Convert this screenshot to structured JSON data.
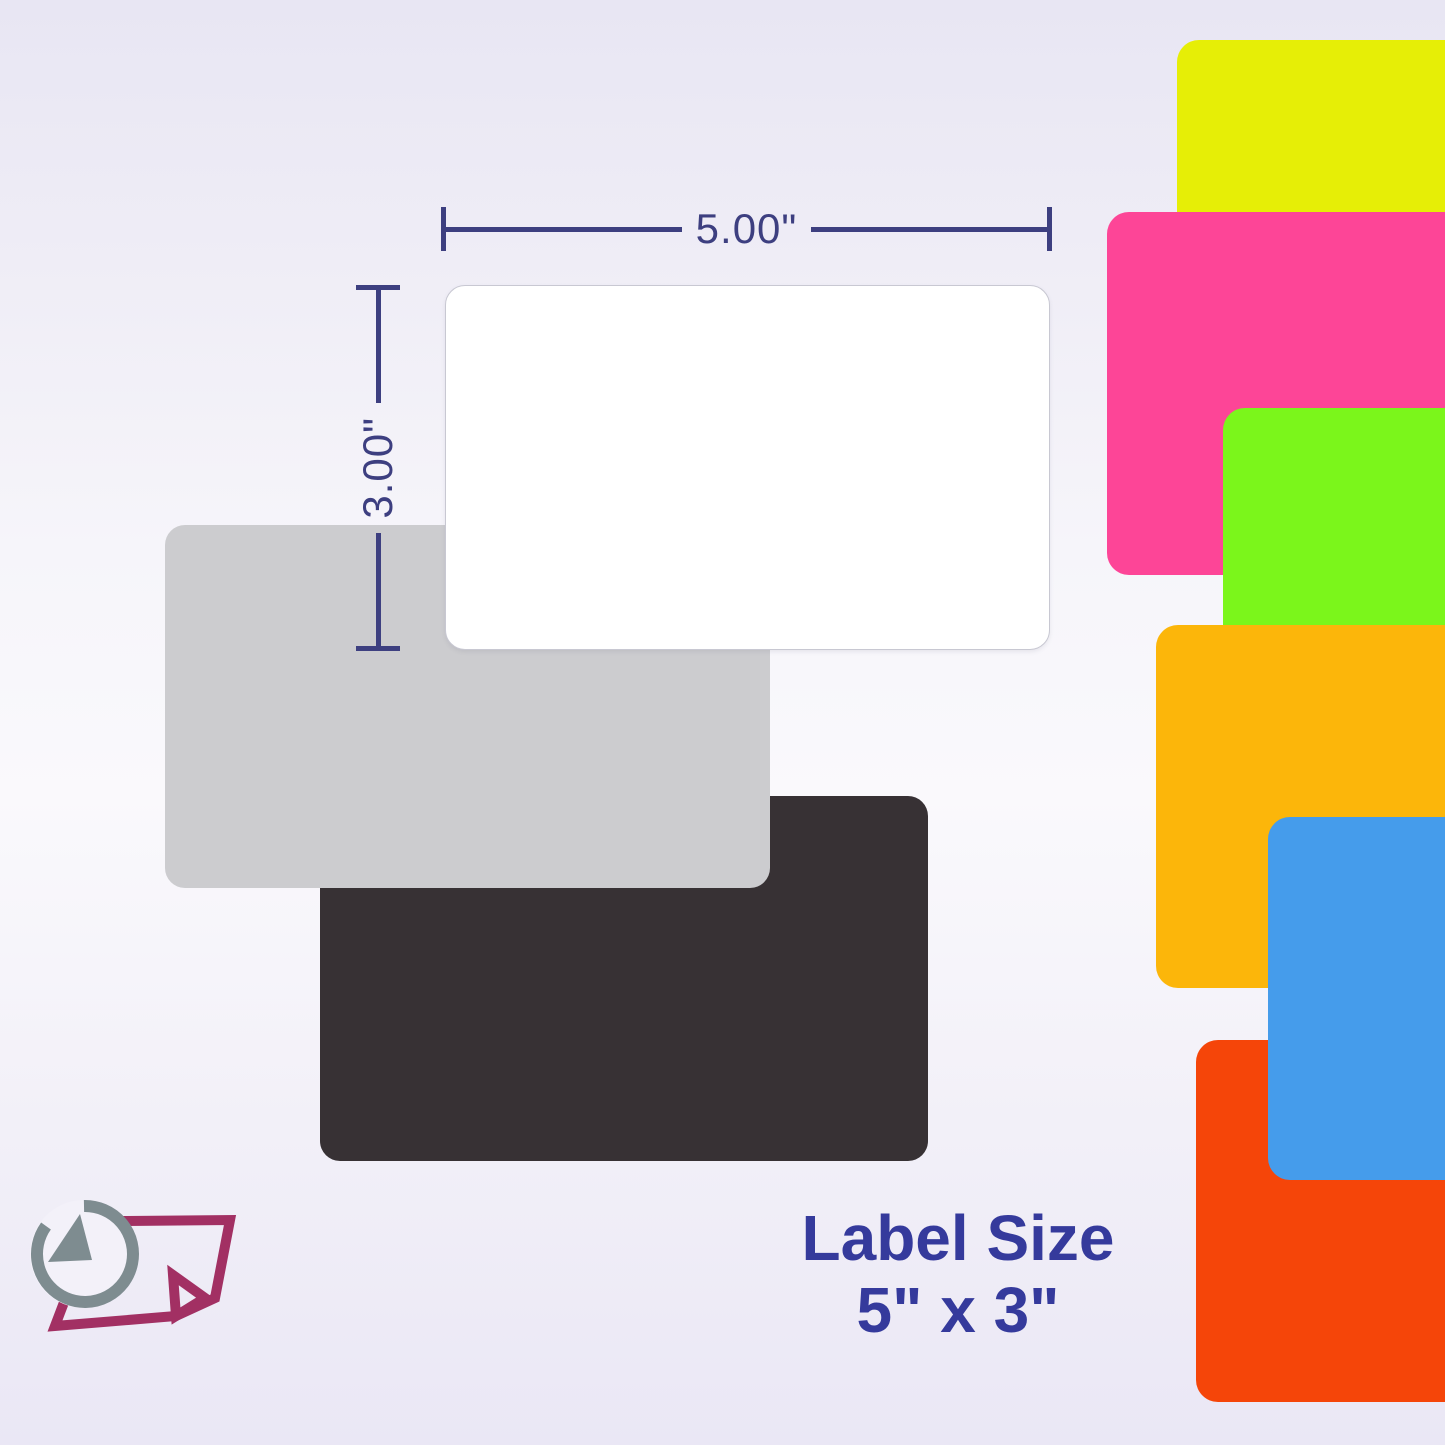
{
  "image_title": "Label size product diagram",
  "dimensions": {
    "width_label": "5.00\"",
    "height_label": "3.00\""
  },
  "caption": {
    "line1": "Label Size",
    "line2": "5\" x 3\""
  },
  "main_labels": [
    {
      "name": "white-label",
      "color": "#ffffff"
    },
    {
      "name": "gray-label",
      "color": "#cccccf"
    },
    {
      "name": "black-label",
      "color": "#373134"
    }
  ],
  "swatches": [
    {
      "name": "fluorescent-yellow-label",
      "color": "#e6ee06"
    },
    {
      "name": "fluorescent-pink-label",
      "color": "#fd4597"
    },
    {
      "name": "fluorescent-green-label",
      "color": "#7bf61b"
    },
    {
      "name": "orange-label",
      "color": "#fcb60a"
    },
    {
      "name": "blue-label",
      "color": "#459ceb"
    },
    {
      "name": "red-orange-label",
      "color": "#f54509"
    }
  ],
  "colors": {
    "dimension_line": "#3d3f80",
    "caption_text": "#353a9c",
    "logo_maroon": "#a23063",
    "logo_slate": "#7e8c90",
    "background_top": "#e8e6f3",
    "background_middle": "#faf9fc",
    "background_bottom": "#eae7f5"
  }
}
